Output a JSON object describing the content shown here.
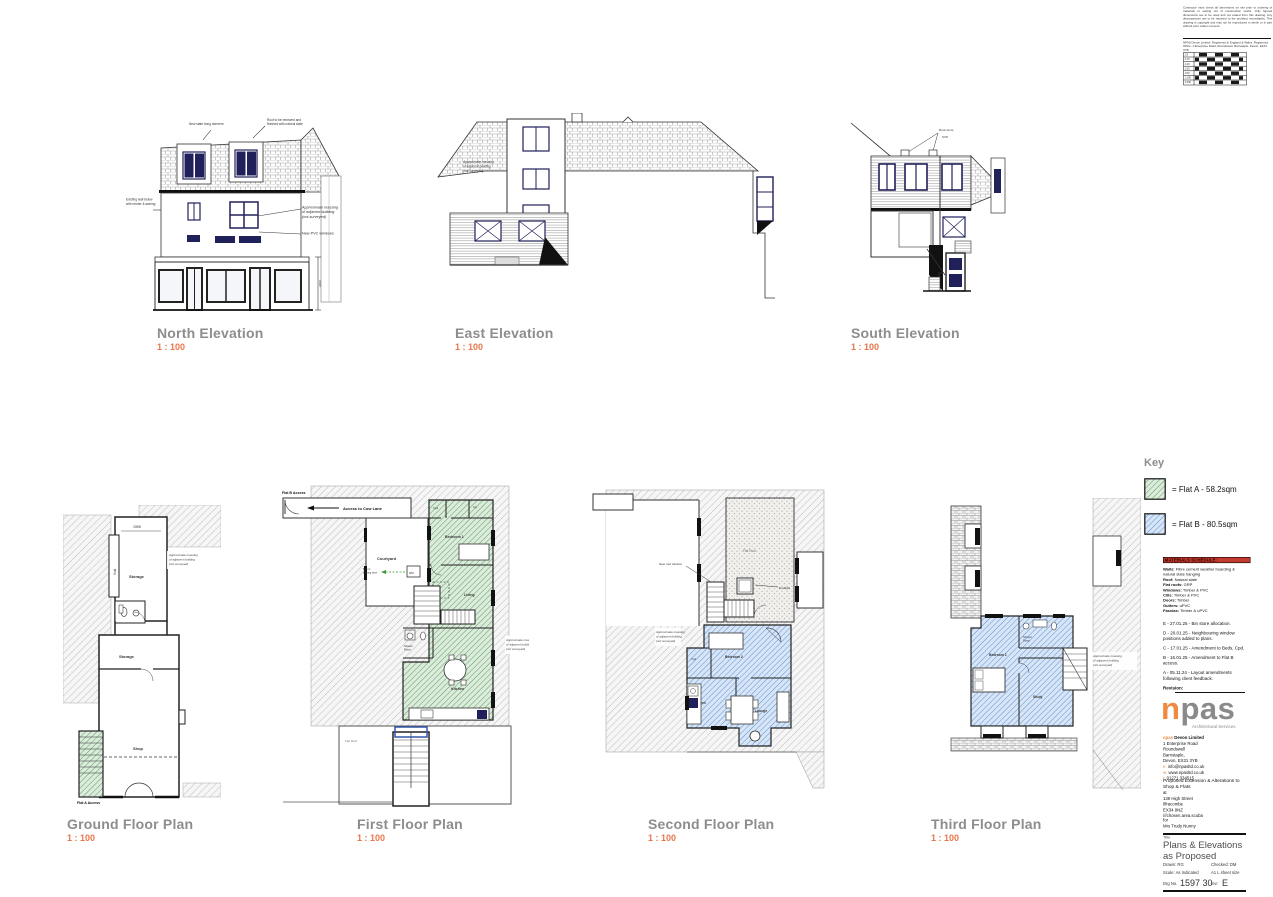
{
  "shared": {
    "massing": [
      "Approximate massing",
      "of adjacent building",
      "(not surveyed)"
    ],
    "scale_value": "1 : 100"
  },
  "top_notes": {
    "disclaimer_1": "Contractor must check all dimensions on site prior to ordering of materials or setting out of construction works. Only figured dimensions are to be used and not scaled from this drawing. Any discrepancies are to be reported to the architect immediately. This drawing is copyright and may not be reproduced in whole or in part without prior written consent.",
    "disclaimer_2": "NPAS Devon Limited. Registered in England & Wales. Registered Office: 1 Enterprise Road, Roundswell, Barnstaple, Devon, EX31 3YB",
    "scales": [
      "1:5",
      "1:10",
      "1:20",
      "1:25",
      "1:50",
      "1:100",
      "1:200"
    ]
  },
  "elevations": {
    "north": {
      "title": "North Elevation",
      "scale": "1 : 100",
      "ann_dormers": "New slate hung dormers",
      "ann_roof": [
        "Roof to be renewed and",
        "finished with natural slate"
      ],
      "ann_wall": [
        "Existing wall below",
        "with render & awning"
      ],
      "ann_windows": "New PVC windows",
      "dim": "2400"
    },
    "east": {
      "title": "East Elevation",
      "scale": "1 : 100"
    },
    "south": {
      "title": "South Elevation",
      "scale": "1 : 100",
      "ann_vents": "Roof vents",
      "ann_svp": "SVP"
    }
  },
  "plans": {
    "ground": {
      "title": "Ground Floor Plan",
      "scale": "1 : 100",
      "dim": "1595",
      "void": "Void",
      "storage1": "Storage",
      "storage2": "Storage",
      "shop": "Shop",
      "access": "Flat A Access"
    },
    "first": {
      "title": "First Floor Plan",
      "scale": "1 : 100",
      "flat_b_access": "Flat B Access",
      "cow_lane": "Access to Cow Lane",
      "courtyard": "Courtyard",
      "bedroom": "Bedroom 1",
      "cpd": "Cpd",
      "cyl": "Cyl",
      "wm": "WM",
      "bins": [
        "Bins to",
        "existing store"
      ],
      "living": "Living",
      "shower1": "Shower",
      "shower2": "Room",
      "kitchen": "Kitchen",
      "flat_roof": "Flat Roof"
    },
    "second": {
      "title": "Second Floor Plan",
      "scale": "1 : 100",
      "flat_roof": "Flat Roof",
      "rooflight": "Rooflight",
      "new_rooflight": "New roof window",
      "bedroom": "Bedroom 2",
      "cpd": "Cpd",
      "kitchen": "Kitchen",
      "lounge": "Lounge"
    },
    "third": {
      "title": "Third Floor Plan",
      "scale": "1 : 100",
      "bedroom": "Bedroom 1",
      "shower1": "Shower",
      "shower2": "Room",
      "study": "Study"
    }
  },
  "key": {
    "title": "Key",
    "flat_a": "= Flat A - 58.2sqm",
    "flat_b": "= Flat B - 80.5sqm",
    "flat_a_color": "#57a05f",
    "flat_b_color": "#5b93d4"
  },
  "materials": {
    "title": "MATERIALS SCHEDULE:",
    "rows": [
      {
        "k": "Walls:",
        "v": "Fibre cement weather boarding & natural slate hanging"
      },
      {
        "k": "Roof:",
        "v": "Natural slate"
      },
      {
        "k": "Flat roofs:",
        "v": "GRP"
      },
      {
        "k": "Windows:",
        "v": "Timber & PVC"
      },
      {
        "k": "Cills:",
        "v": "Timber & PVC"
      },
      {
        "k": "Doors:",
        "v": "Timber"
      },
      {
        "k": "Gutters:",
        "v": "uPVC"
      },
      {
        "k": "Fascias:",
        "v": "Timber & uPVC"
      }
    ]
  },
  "revisions": {
    "items": [
      "E - 27.01.25 - Bin store allocation.",
      "D - 20.01.25 - Neighbouring window positions added to plans.",
      "C - 17.01.25 - Amendment to Beds, Cpd.",
      "B - 16.01.25 - Amendment to Flat B access.",
      "A - 05.11.24 - Layout amendments following client feedback."
    ],
    "label": "Revision:"
  },
  "logo": {
    "n": "n",
    "pas": "pas",
    "tagline": "Architectural Services"
  },
  "firm": {
    "name_bold": "npas",
    "name_rest": " Devon Limited",
    "addr1": "1 Enterprise Road",
    "addr2": "Roundswell",
    "addr3": "Barnstaple,",
    "addr4": "Devon, EX31 3YB",
    "email_k": "e:",
    "email_v": " info@npasltd.co.uk",
    "web_k": "w:",
    "web_v": " www.npasltd.co.uk",
    "tel_k": "t:",
    "tel_v": " 01271 334515"
  },
  "project": {
    "description": "Proposed Extension & Alterations to Shop & Flats",
    "at": "at",
    "site1": "139 High Street",
    "site2": "Ilfracombe",
    "site3": "EX34 9NZ",
    "site4": "///chosen.area.scuba",
    "for": "for",
    "client": "Mrs Trudy Nunny",
    "title_label": "Title",
    "title1": "Plans & Elevations",
    "title2": "as Proposed"
  },
  "tb": {
    "drawn_l": "Drawn:",
    "drawn": "RG",
    "checked_l": "Checked:",
    "checked": "DM",
    "scale_l": "Scale:",
    "scale": "As Indicated",
    "sheet": "A1 L sheet size",
    "drg_l": "Drg No.",
    "drg": "1597 30",
    "rev_l": "rev:",
    "rev": "E"
  }
}
